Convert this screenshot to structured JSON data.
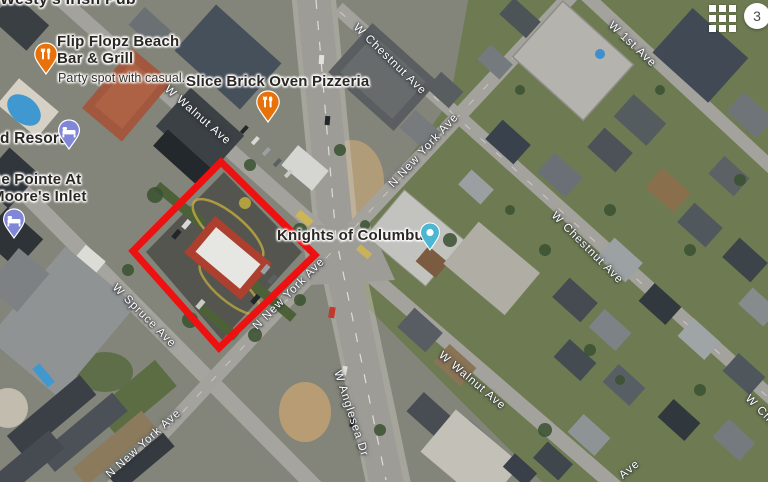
{
  "map": {
    "pois": {
      "westys": "Westy's Irish Pub",
      "flip_line1": "Flip Flopz Beach",
      "flip_line2": "Bar & Grill",
      "flip_subtitle": "Party spot with casual...",
      "slice": "Slice Brick Oven Pizzeria",
      "knights": "Knights of Columbus",
      "resort": "d Resort",
      "pointe_line1": "he Pointe At",
      "pointe_line2": "Moore's Inlet"
    },
    "streets": {
      "walnut": "W Walnut Ave",
      "chestnut": "W Chestnut Ave",
      "first": "W 1st Ave",
      "newyork": "N New York Ave",
      "spruce": "W Spruce Ave",
      "anglesea": "W Anglesea Dr",
      "ave_fragment": "Ave"
    },
    "overlay": {
      "badge": "3"
    },
    "colors": {
      "annotation_red": "#EE1111",
      "restaurant_pin": "#E8710A",
      "lodging_pin": "#8187D8",
      "place_pin": "#4DB6D1",
      "street_label": "#FFFFFF",
      "poi_label": "#2A2723"
    }
  }
}
